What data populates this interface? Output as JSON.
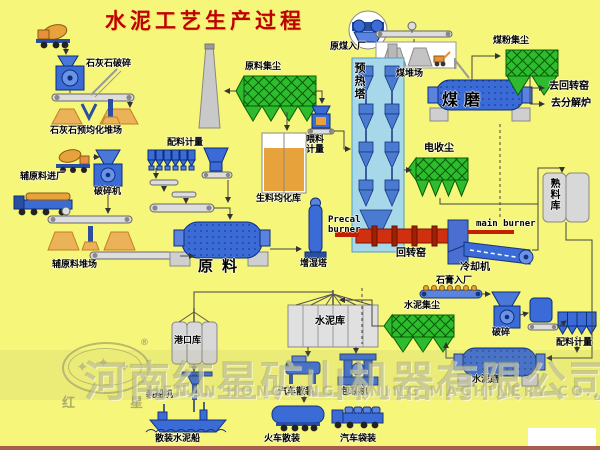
{
  "title": "水泥工艺生产过程",
  "labels": {
    "limestone_crushing": "石灰石破碎",
    "limestone_preblending_yard": "石灰石预均化堆场",
    "raw_material_dust_collection": "原料集尘",
    "raw_coal_entry": "原煤入厂",
    "coal_yard": "煤堆场",
    "coal_powder_dust_collection": "煤粉集尘",
    "coal_mill": "煤磨",
    "to_rotary_kiln": "去回转窑",
    "to_calciner": "去分解炉",
    "auxiliary_material_entry": "辅原料进厂",
    "crusher_machine": "破碎机",
    "batching_metering_1": "配料计量",
    "feeding_metering": "喂料计量",
    "raw_meal_homogenizing_silo": "生料均化库",
    "preheater_tower": "预热塔",
    "auxiliary_material_yard": "辅原料堆场",
    "raw_mill": "原料",
    "humidifying_tower": "增湿塔",
    "precal_burner": "Precal burner",
    "electrostatic_precipitator": "电收尘",
    "rotary_kiln": "回转窑",
    "main_burner": "main burner",
    "cooler": "冷却机",
    "clinker_silo": "熟料库",
    "gypsum_entry": "石膏入厂",
    "crushing": "破碎",
    "batching_metering_2": "配料计量",
    "cement_dust_collection": "水泥集尘",
    "cement_silo": "水泥库",
    "cement_mill": "水泥磨",
    "port_silo": "港口库",
    "ship_loader": "装船机",
    "truck_bulk_loading": "汽车散装",
    "packing_machine": "包装机",
    "bulk_cement_ship": "散装水泥船",
    "train_bulk_loading": "火车散装",
    "truck_bag_loading": "汽车袋装"
  },
  "watermark": {
    "company_cn": "河南红星矿山机器有限公司",
    "company_en": "HENAN HONGXING MINING MACHINERY CO., LTD",
    "logo_char_left": "红",
    "logo_char_right": "星",
    "registered_mark": "®",
    "star_glyph": "✦"
  },
  "colors": {
    "background": "#F6F67A",
    "title_red": "#C00000",
    "equipment_blue": "#3A6BD6",
    "equipment_blue_dark": "#0c2f7a",
    "collector_green": "#2EBB2E",
    "kiln_red": "#D03010",
    "material_orange": "#E8A23C",
    "tower_light_blue": "#A6D8EA",
    "silo_gray": "#D8D8D8"
  }
}
